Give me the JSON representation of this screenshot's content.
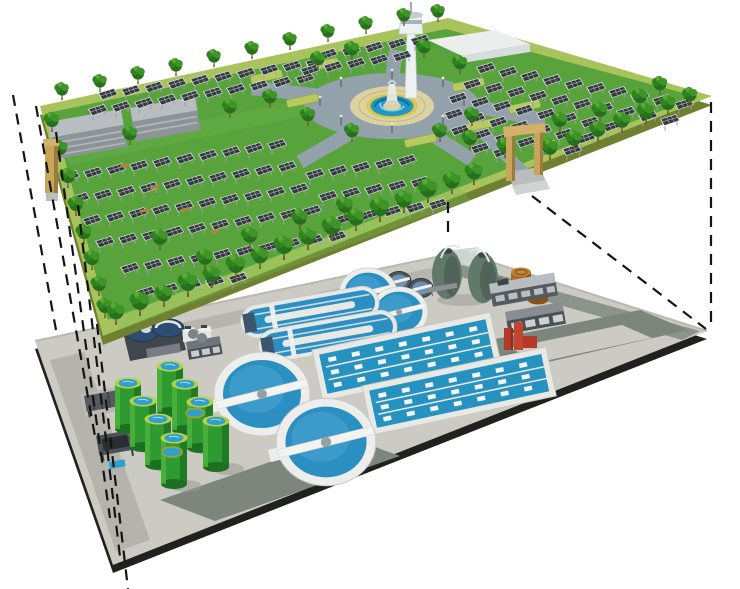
{
  "image": {
    "kind": "3D cutaway architectural illustration",
    "subject": "Underground wastewater treatment plant beneath a landscaped solar-panel park",
    "background": "#ffffff"
  },
  "upper_layer": {
    "name": "surface park with solar farm",
    "features": {
      "solar_arrays": "rows of tilted dark photovoltaic panels on posts",
      "trees": "ornamental green trees across the lawn and along all edges",
      "plaza": "circular central plaza with tiered fountain, blue water rings and grey ring road",
      "tower": "white observation tower behind the plaza",
      "buildings": "two long grey service sheds at the rear left",
      "gates": "tan portal gate frames on the left and right front edges",
      "lawn": "green lawn bordered by a light yellow-green perimeter walkway"
    }
  },
  "lower_layer": {
    "name": "underground wastewater treatment works on grey paved deck",
    "equipment_counts": {
      "large_clarifiers": 2,
      "medium_clarifiers": 2,
      "small_dark_tanks": 2,
      "oxidation_ditches": 2,
      "aeration_basins": 2,
      "egg_digesters": 2,
      "brown_sludge_drums": 2,
      "green_storage_tanks": 8,
      "covered_blue_tanks": 2,
      "service_buildings": 3,
      "red_pump_unit": 1,
      "skylight_frames": 2
    }
  },
  "annotations": {
    "projection_lines": "black dashed lines projecting the park footprint down onto the buried plant deck",
    "left_dashed_lines": 5,
    "right_dashed_lines": 2,
    "center_dashed_lines": 1
  },
  "colors": {
    "bg": "#ffffff",
    "parkGrass": "#58a33c",
    "parkGrassLight": "#74bd55",
    "parkBand": "#a9c35c",
    "parkSide": "#6f8030",
    "treeDark": "#266f1d",
    "treeMid": "#2f831f",
    "treeLight": "#3f9427",
    "treeHighlight": "#57ab35",
    "trunk": "#7a5a30",
    "panelCell": "#343a3e",
    "panelFrame": "#dfe3e6",
    "panelGrid": "#cfd4d8",
    "panelLeg": "#9aa0a4",
    "buildingRoof": "#b9bdc1",
    "buildingFront": "#8e9398",
    "plazaRoad": "#93a1aa",
    "plazaPave": "#dbd1a1",
    "plazaYellow": "#d9c94e",
    "plazaWater": "#2496c6",
    "plazaWaterDark": "#0f6d9a",
    "plazaWaterLight": "#7fd0ea",
    "fountainWhite": "#eceae2",
    "hedge": "#b7ca5e",
    "towerWhite": "#eef1f1",
    "towerShade": "#c6cccc",
    "gateTan": "#c9a55c",
    "gateShade": "#9a7c3e",
    "gateTop": "#d4b06a",
    "plantSurface": "#cbcbc3",
    "plantRoad": "#7c867c",
    "plantRoadLight": "#b5b5ad",
    "plantEdge": "#20201e",
    "clarRim": "#ededeb",
    "clarWater": "#2b8fc2",
    "clarWaterLight": "#51abd6",
    "basinWall": "#e8e9e5",
    "basinWater": "#2692c0",
    "tankGreen": "#2f9a2f",
    "tankGreenDark": "#1d7022",
    "tankGreenLight": "#4fb53d",
    "tankRim": "#b7d149",
    "tankWater": "#2e9fd0",
    "digester": "#61796a",
    "digesterDark": "#3d4a42",
    "drum": "#a96a24",
    "drumTop": "#c08536",
    "redStruct": "#b33a28",
    "darkBuilding": "#555a60",
    "coveredTank": "#2e4d72",
    "dash": "#141414"
  }
}
